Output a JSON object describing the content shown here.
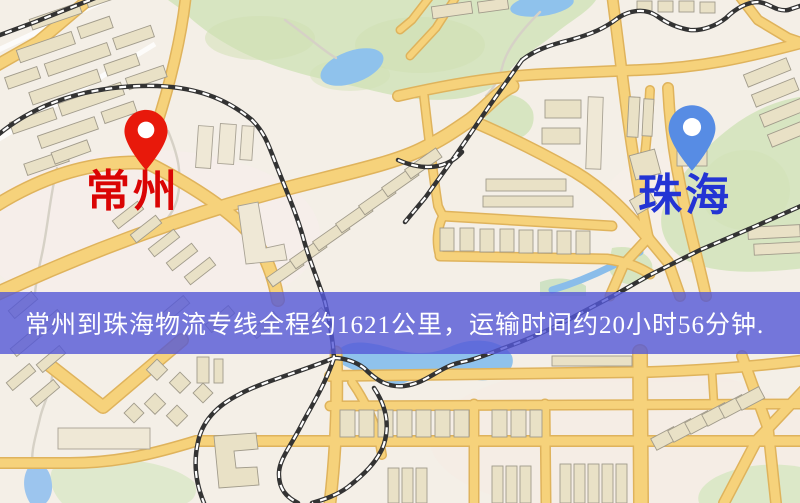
{
  "map": {
    "origin": {
      "label": "常州"
    },
    "destination": {
      "label": "珠海"
    }
  },
  "banner": {
    "text": "常州到珠海物流专线全程约1621公里，运输时间约20小时56分钟."
  },
  "icons": {
    "origin_pin": "red-map-pin-icon",
    "destination_pin": "blue-map-pin-icon"
  },
  "colors": {
    "banner_background": "#5457d7",
    "banner_text": "#ffffff",
    "origin_label": "#da0404",
    "destination_label": "#2334d4",
    "origin_pin": "#e8190b",
    "destination_pin": "#578ce4",
    "road_major": "#f6d27b",
    "road_casing": "#dfb35c",
    "water": "#8fc2ec",
    "park": "#d7e5c1",
    "building": "#e9e1c6",
    "railway": "#333333",
    "background": "#f4efe7"
  }
}
